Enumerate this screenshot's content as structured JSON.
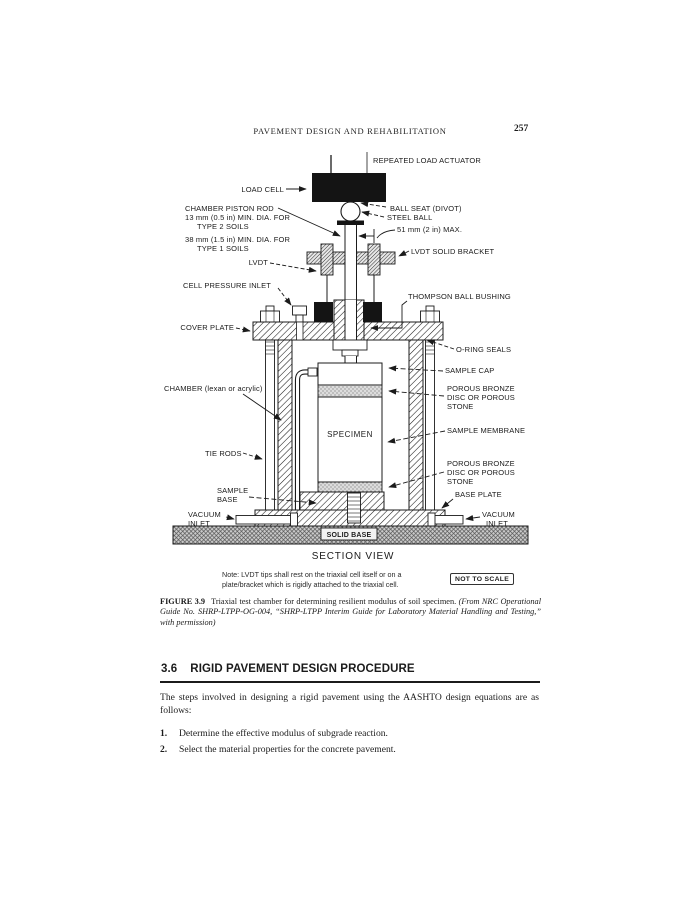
{
  "header": {
    "running_title": "PAVEMENT DESIGN AND REHABILITATION",
    "page_number": "257"
  },
  "figure": {
    "labels": {
      "repeated_load_actuator": "REPEATED LOAD ACTUATOR",
      "load_cell": "LOAD CELL",
      "ball_seat": "BALL SEAT (DIVOT)",
      "steel_ball": "STEEL BALL",
      "ball_max": "51 mm (2 in) MAX.",
      "piston_rod_1": "CHAMBER PISTON ROD",
      "piston_rod_2": "13 mm (0.5 in) MIN. DIA. FOR",
      "piston_rod_3": "TYPE 2 SOILS",
      "piston_rod_4": "38 mm (1.5 in) MIN. DIA. FOR",
      "piston_rod_5": "TYPE 1 SOILS",
      "lvdt": "LVDT",
      "lvdt_bracket": "LVDT SOLID BRACKET",
      "cell_pressure_inlet": "CELL PRESSURE INLET",
      "thompson_bushing": "THOMPSON BALL BUSHING",
      "cover_plate": "COVER PLATE",
      "o_ring_seals": "O-RING SEALS",
      "sample_cap": "SAMPLE CAP",
      "chamber": "CHAMBER (lexan or acrylic)",
      "porous_line1": "POROUS BRONZE",
      "porous_line2": "DISC OR POROUS",
      "porous_line3": "STONE",
      "specimen": "SPECIMEN",
      "sample_membrane": "SAMPLE MEMBRANE",
      "tie_rods": "TIE RODS",
      "sample_word": "SAMPLE",
      "base_word": "BASE",
      "base_plate": "BASE PLATE",
      "vacuum_word": "VACUUM",
      "inlet_word": "INLET",
      "solid_base": "SOLID BASE",
      "section_view": "SECTION VIEW"
    },
    "note": {
      "line1": "Note:  LVDT tips shall rest on the triaxial cell itself or on a",
      "line2": "plate/bracket which is rigidly attached to the triaxial cell."
    },
    "not_to_scale": "NOT TO SCALE",
    "caption": {
      "number": "FIGURE 3.9",
      "text": "Triaxial test chamber for determining resilient modulus of soil specimen. ",
      "source": "(From NRC Operational Guide No. SHRP-LTPP-OG-004, “SHRP-LTPP Interim Guide for Laboratory Material Handling and Testing,” with permission)"
    }
  },
  "section": {
    "number": "3.6",
    "title": "RIGID PAVEMENT DESIGN PROCEDURE",
    "intro": "The steps involved in designing a rigid pavement using the AASHTO design equations are as follows:",
    "steps": [
      {
        "num": "1.",
        "text": "Determine the effective modulus of subgrade reaction."
      },
      {
        "num": "2.",
        "text": "Select the material properties for the concrete pavement."
      }
    ]
  }
}
